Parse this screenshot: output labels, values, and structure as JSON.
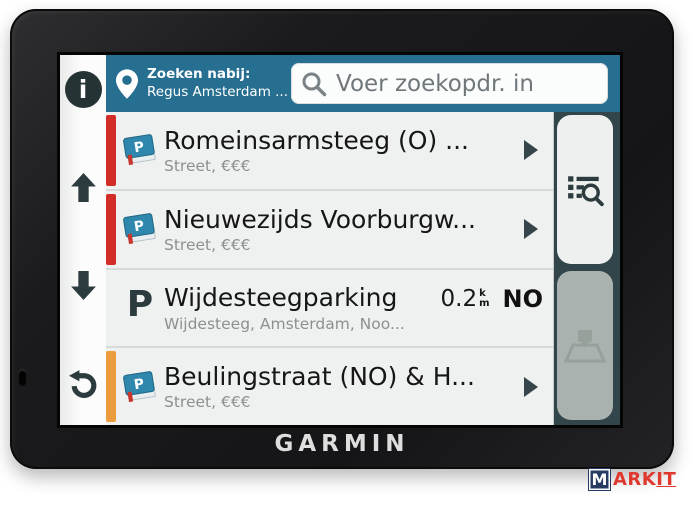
{
  "brand": "GARMIN",
  "header": {
    "nearby_label": "Zoeken nabij:",
    "nearby_value": "Regus Amsterdam ...",
    "search_placeholder": "Voer zoekopdr. in"
  },
  "results": [
    {
      "title": "Romeinsarmsteeg (O) ...",
      "subtitle": "Street, €€€",
      "stripe": "red",
      "icon": "parking-book",
      "has_arrow": true
    },
    {
      "title": "Nieuwezijds Voorburgw...",
      "subtitle": "Street, €€€",
      "stripe": "red",
      "icon": "parking-book",
      "has_arrow": true
    },
    {
      "title": "Wijdesteegparking",
      "subtitle": "Wijdesteeg, Amsterdam, Noo...",
      "stripe": "none",
      "icon": "parking-letter",
      "distance": "0.2",
      "unit_top": "k",
      "unit_bottom": "m",
      "direction": "NO",
      "has_arrow": false
    },
    {
      "title": "Beulingstraat (NO) & H...",
      "subtitle": "Street, €€€",
      "stripe": "orange",
      "icon": "parking-book",
      "has_arrow": true
    }
  ],
  "icons": {
    "info_letter": "i",
    "parking_letter": "P"
  },
  "left_toolbar": [
    "info",
    "scroll-up",
    "scroll-down",
    "back"
  ],
  "right_tabs": [
    {
      "name": "search-results",
      "active": true
    },
    {
      "name": "map",
      "active": false
    }
  ],
  "watermark": {
    "boxed": "M",
    "mid": "ARK",
    "end": "IT"
  },
  "colors": {
    "header_teal": "#276f90",
    "stripe_red": "#d22d26",
    "stripe_orange": "#eb9c3d",
    "tab_column_dark": "#32454a",
    "icon_slate": "#2c3b3d",
    "poi_book_blue": "#2f87ae"
  }
}
